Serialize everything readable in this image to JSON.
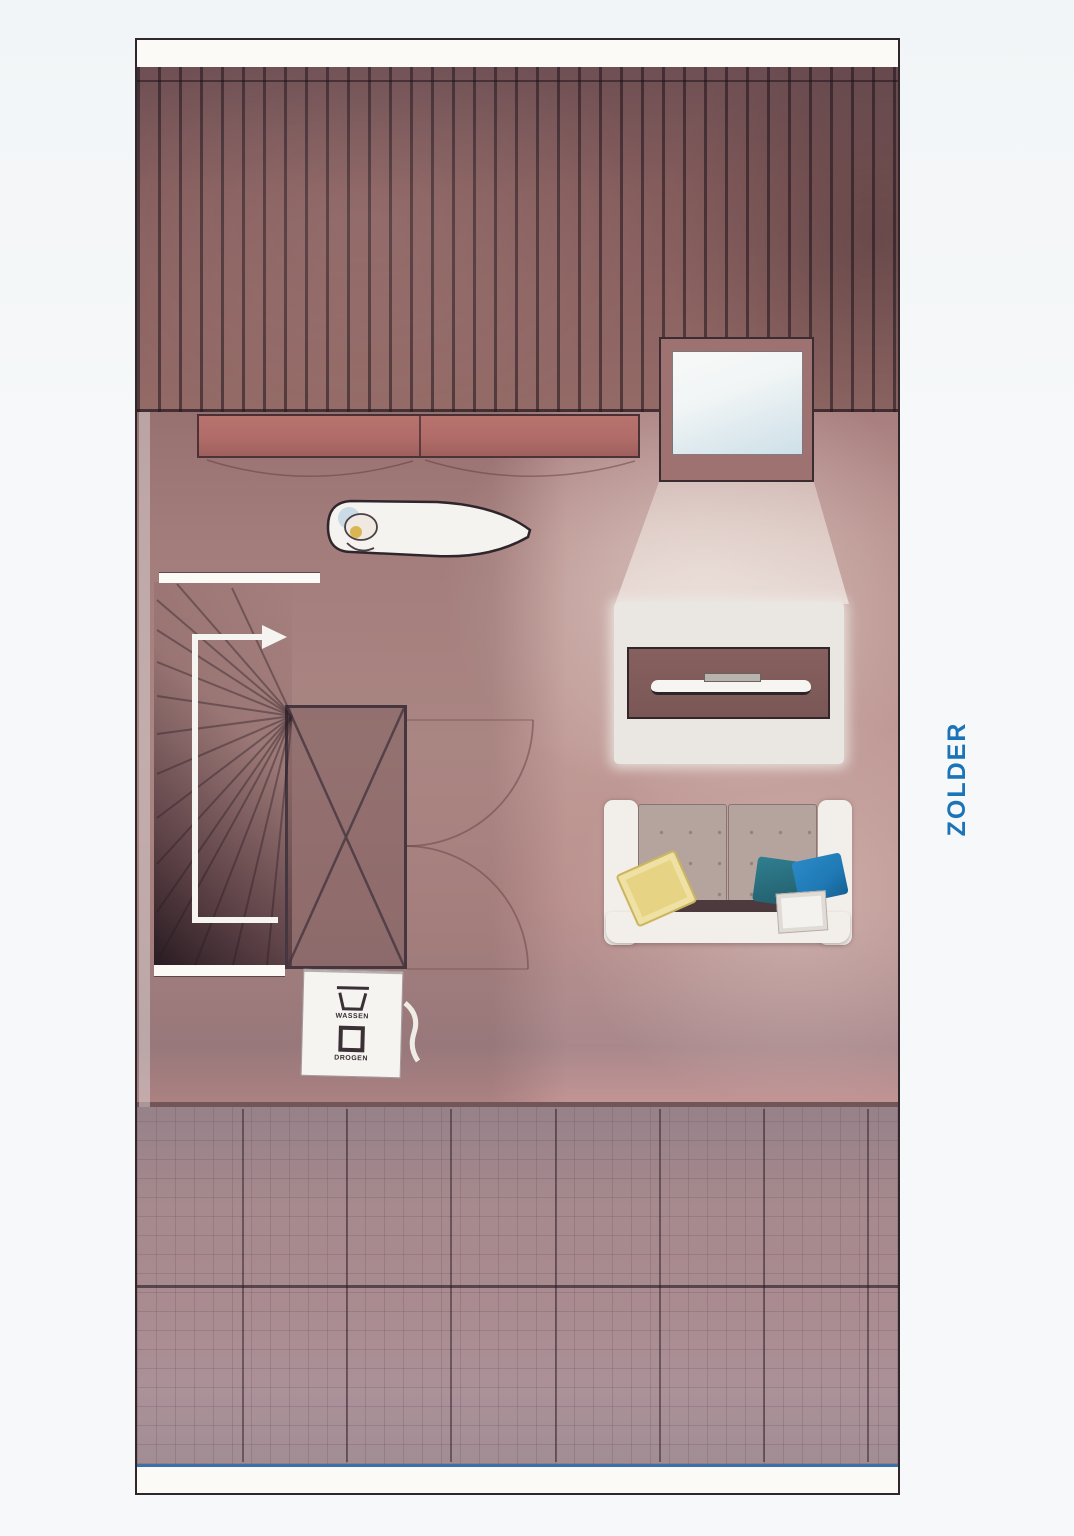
{
  "page": {
    "room_label": "ZOLDER"
  },
  "plan": {
    "appliances": {
      "wash_label": "WASSEN",
      "dry_label": "DROGEN"
    },
    "colors": {
      "accent-blue": "#1b74b8",
      "roof-base": "#8a605f",
      "roof-stripe": "#42323a",
      "floor-base": "#b58c8a",
      "wall-white": "#fbfaf6",
      "cabinet-red": "#b06c68",
      "skylight-frame": "#9d7270",
      "tv-dark": "#7a5756",
      "sofa-frame": "#f2efeb",
      "cushion-taupe": "#b5a49d",
      "pillow-yellow": "#e6d484",
      "pillow-teal": "#2f7f90",
      "pillow-blue": "#1f79b4",
      "tile-base": "#a98b90",
      "edge-blue": "#3d6fa8"
    }
  }
}
